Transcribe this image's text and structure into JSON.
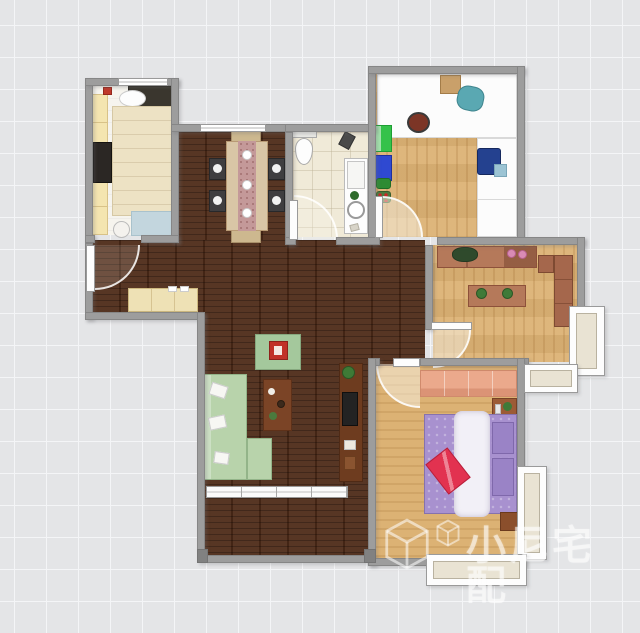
{
  "watermark": {
    "text": "小尼宅配",
    "logo_icon": "cube-3d-icon",
    "logo_icon_small": "cube-3d-small-icon"
  },
  "colors": {
    "grid_bg": "#e4e5e7",
    "grid_line": "#f4f5f7",
    "wall": "#9d9d9d",
    "wall_edge": "#868686",
    "wood_dark": "#4e2b18",
    "wood_light": "#dcb274",
    "tile": "#f0ead8",
    "room_white": "#f6f4ee",
    "bay_fill": "#e9e3d3",
    "sofa_green": "#b8d3ab",
    "rug_green": "#a4c89c",
    "rug_blue": "#c3d6de",
    "coffee_table_brown": "#7b4426",
    "tv_cabinet_brown": "#6e3c1f",
    "shelf_brown": "#b5795a",
    "sofa_brown": "#a5674c",
    "dining_table_tan": "#d9c6a6",
    "runner_pink": "#c49999",
    "chair_dark": "#3f3e40",
    "bed_cream": "#ede2c4",
    "wardrobe_yellow": "#f4e5b0",
    "shoe_cabinet_tan": "#eee1b5",
    "bed_purple": "#a891cf",
    "bed_runner_white": "#f2f0f7",
    "pillow_red": "#e23250",
    "wardrobe_salmon": "#eba98c",
    "nightstand_brown": "#8b4f2c",
    "desk_white": "#fcfcfc",
    "chair_navy": "#24418f",
    "chair_teal": "#5aa8b2",
    "cabinet_green": "#35c24a",
    "box_blue": "#2f49d1",
    "watermark_color": "rgba(255,255,255,0.55)"
  }
}
